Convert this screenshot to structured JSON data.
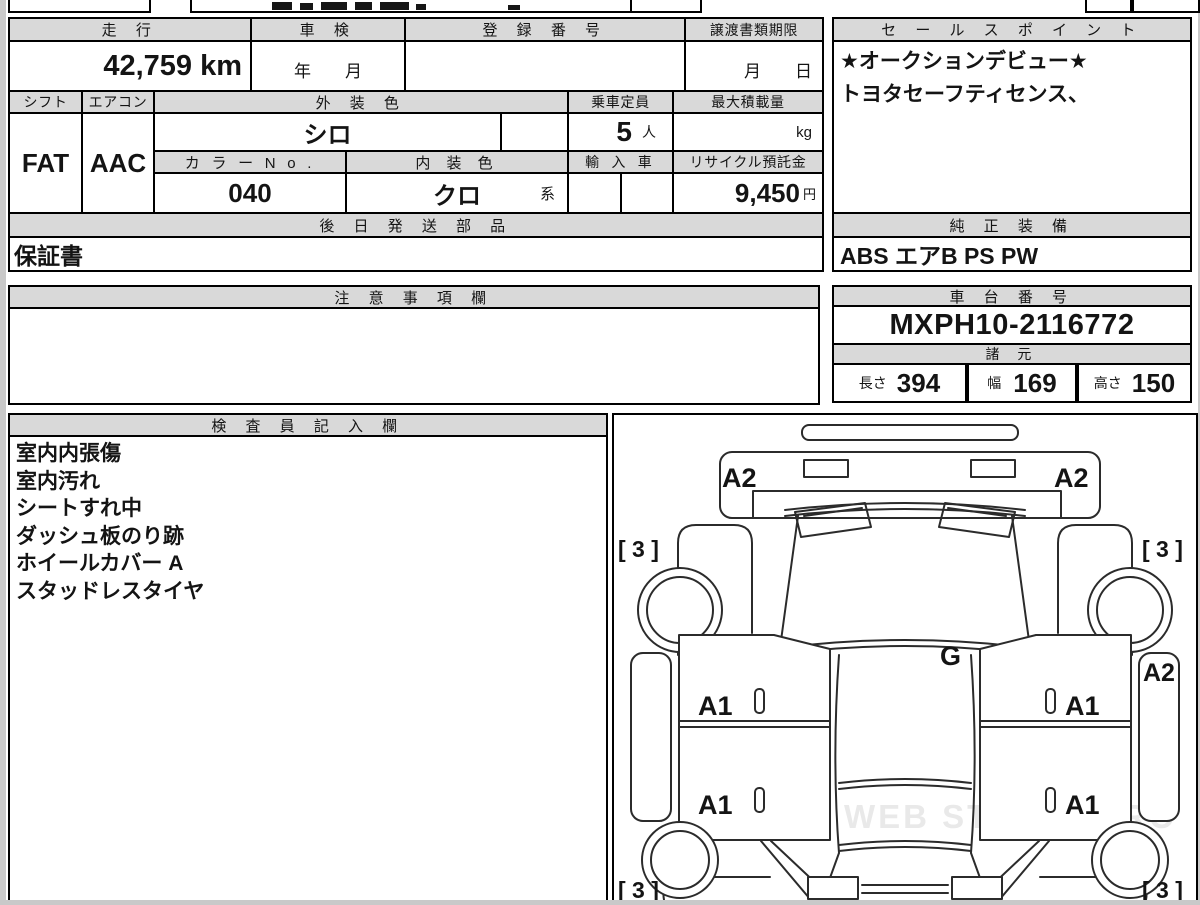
{
  "table": {
    "mileage_header": "走 行",
    "mileage_value": "42,759 km",
    "shaken_header": "車 検",
    "shaken_value": "年　　月",
    "registration_header": "登 録 番 号",
    "registration_value": "",
    "transfer_header": "譲渡書類期限",
    "transfer_value": "月　　日",
    "shift_header": "シフト",
    "shift_value": "FAT",
    "aircon_header": "エアコン",
    "aircon_value": "AAC",
    "ext_color_header": "外 装 色",
    "ext_color_value": "シロ",
    "capacity_header": "乗車定員",
    "capacity_value": "5",
    "capacity_unit": "人",
    "max_load_header": "最大積載量",
    "max_load_unit": "kg",
    "color_no_header": "カ ラ ー N o .",
    "color_no_value": "040",
    "int_color_header": "内 装 色",
    "int_color_value": "クロ",
    "int_color_suffix": "系",
    "import_header": "輸 入 車",
    "recycle_header": "リサイクル預託金",
    "recycle_value": "9,450",
    "recycle_unit": "円",
    "later_parts_header": "後 日 発 送 部 品",
    "later_parts_value": "保証書"
  },
  "sales_point": {
    "header": "セ ー ル ス ポ イ ン ト",
    "lines": [
      "★オークションデビュー★",
      "トヨタセーフティセンス、"
    ]
  },
  "equipment": {
    "header": "純 正 装 備",
    "value": "ABS エアB PS PW"
  },
  "notes": {
    "header": "注 意 事 項 欄",
    "value": ""
  },
  "chassis": {
    "header": "車 台 番 号",
    "value": "MXPH10-2116772"
  },
  "specs": {
    "header": "諸 元",
    "length_label": "長さ",
    "length_value": "394",
    "width_label": "幅",
    "width_value": "169",
    "height_label": "高さ",
    "height_value": "150"
  },
  "inspector": {
    "header": "検 査 員 記 入 欄",
    "lines": [
      "室内内張傷",
      "室内汚れ",
      "シートすれ中",
      "ダッシュ板のり跡",
      "ホイールカバー A",
      "スタッドレスタイヤ"
    ]
  },
  "diagram": {
    "watermark": "WEB STUDIO.PRO",
    "hood_left": "A2",
    "hood_right": "A2",
    "rocker_right": "A2",
    "glass": "G",
    "door_fl": "A1",
    "door_rl": "A1",
    "door_fr": "A1",
    "door_rr": "A1",
    "corner_fl": "[ 3 ]",
    "corner_fr": "[ 3 ]",
    "corner_rl": "[ 3 ]",
    "corner_rr": "[ 3 ]"
  }
}
